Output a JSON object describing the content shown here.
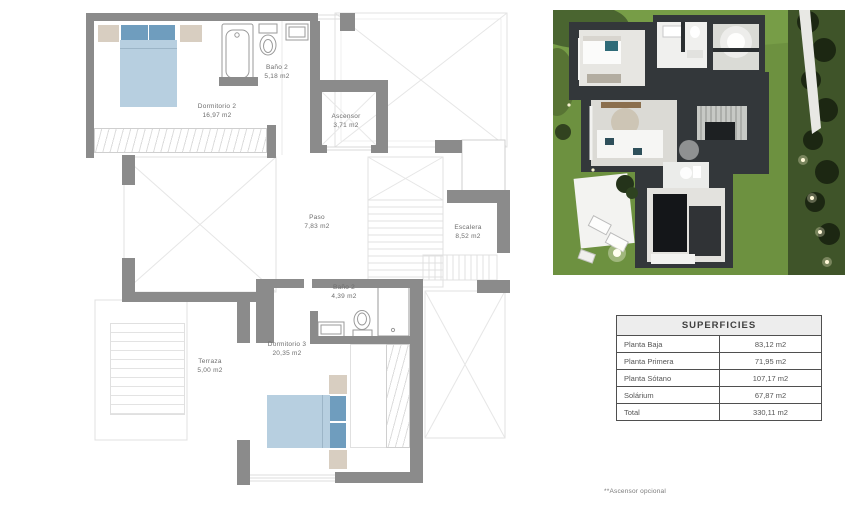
{
  "floorplan": {
    "rooms": [
      {
        "name": "Dormitorio 2",
        "area": "16,97 m2"
      },
      {
        "name": "Baño 2",
        "area": "5,18 m2"
      },
      {
        "name": "Ascensor",
        "area": "3,71 m2"
      },
      {
        "name": "Paso",
        "area": "7,83 m2"
      },
      {
        "name": "Escalera",
        "area": "8,52 m2"
      },
      {
        "name": "Baño 2",
        "area": "4,39 m2"
      },
      {
        "name": "Dormitorio 3",
        "area": "20,35 m2"
      },
      {
        "name": "Terraza",
        "area": "5,00 m2"
      }
    ],
    "colors": {
      "wall": "#8b8b8b",
      "bed": "#b7cfe0",
      "pillow": "#6f9dbe",
      "nightstand": "#d8cec1",
      "label_text": "#6d6d6d"
    }
  },
  "table": {
    "title": "SUPERFICIES",
    "rows": [
      {
        "label": "Planta Baja",
        "value": "83,12 m2"
      },
      {
        "label": "Planta Primera",
        "value": "71,95 m2"
      },
      {
        "label": "Planta Sótano",
        "value": "107,17 m2"
      },
      {
        "label": "Solárium",
        "value": "67,87 m2"
      },
      {
        "label": "Total",
        "value": "330,11 m2"
      }
    ]
  },
  "footnote": "**Ascensor opcional",
  "render": {
    "colors": {
      "grass": "#6d9140",
      "house_wall": "#33373a",
      "floor": "#e6e5e1"
    }
  }
}
